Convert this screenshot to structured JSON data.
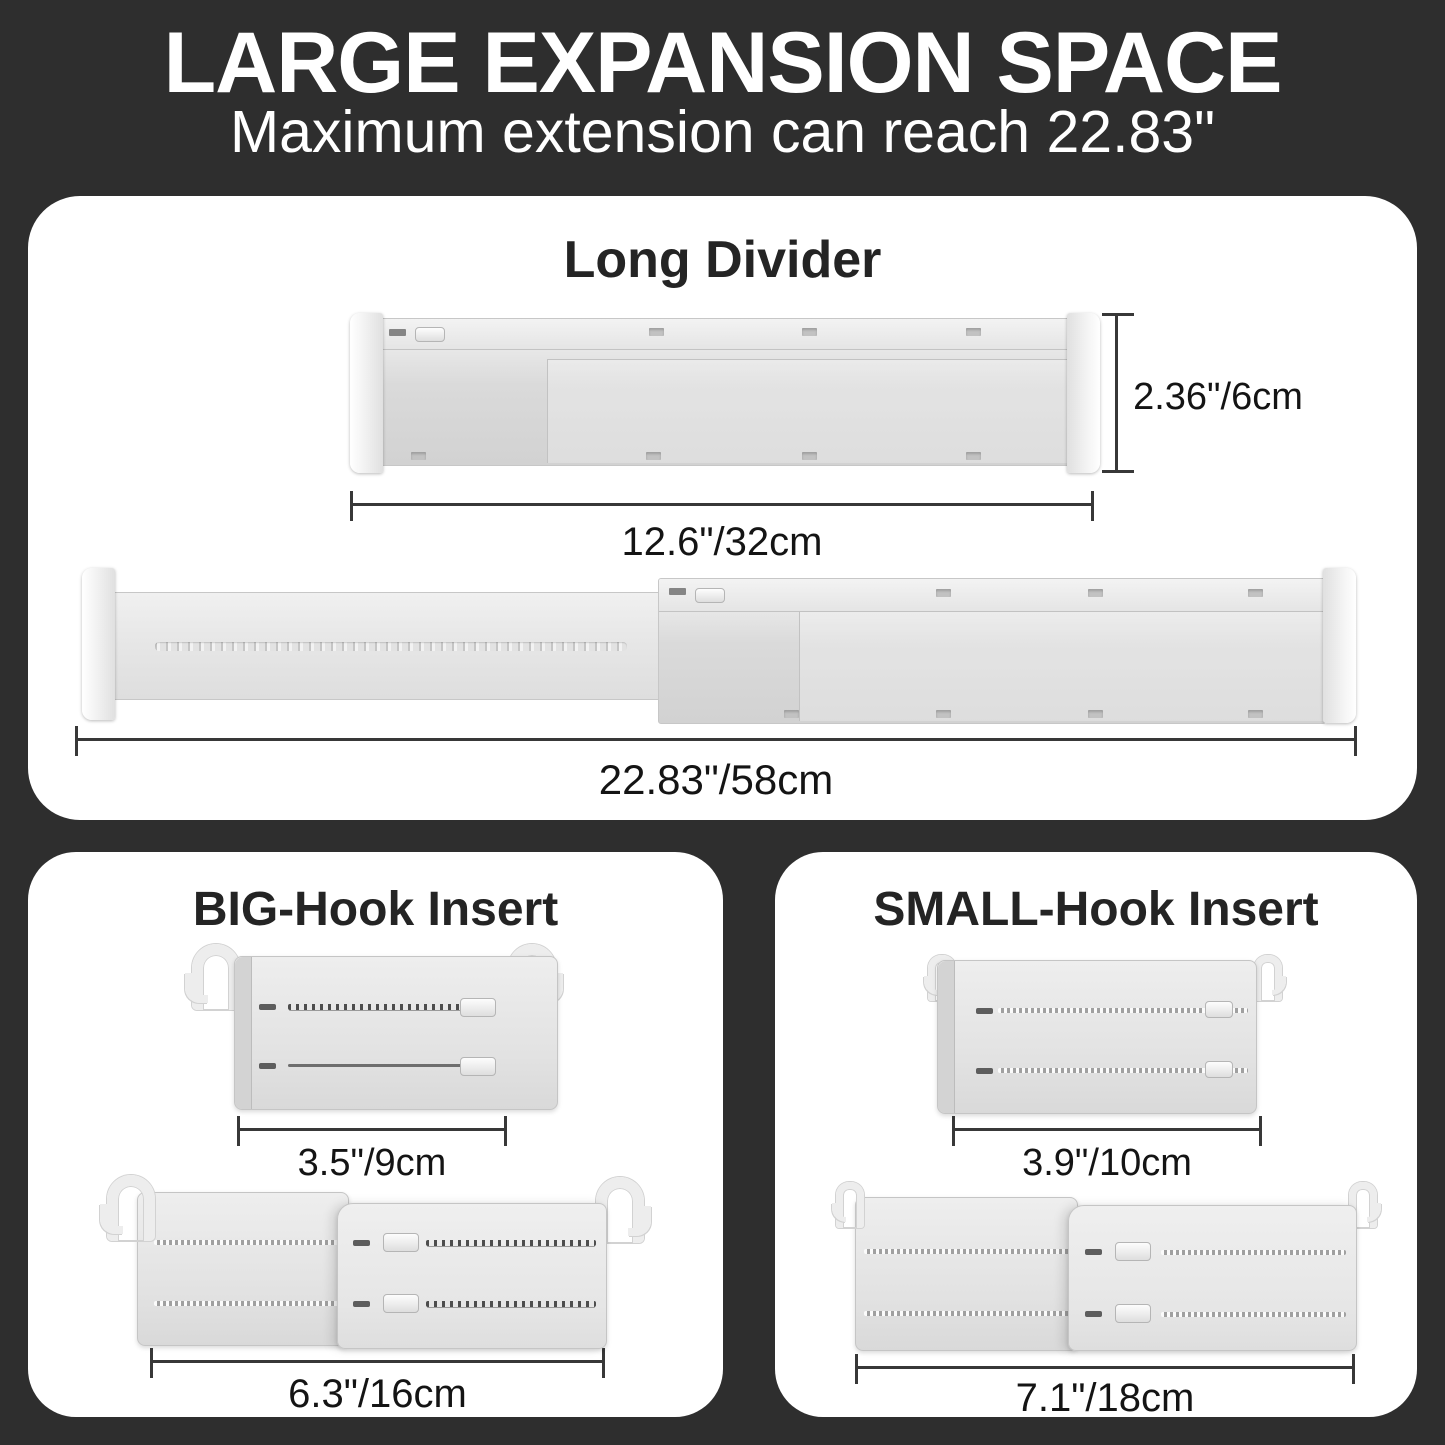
{
  "header": {
    "title": "LARGE EXPANSION SPACE",
    "subtitle": "Maximum extension can reach 22.83\""
  },
  "long_divider": {
    "title": "Long Divider",
    "collapsed_height_label": "2.36\"/6cm",
    "collapsed_width_label": "12.6\"/32cm",
    "extended_width_label": "22.83\"/58cm"
  },
  "big_hook": {
    "title": "BIG-Hook Insert",
    "compact_width_label": "3.5\"/9cm",
    "extended_width_label": "6.3\"/16cm"
  },
  "small_hook": {
    "title": "SMALL-Hook Insert",
    "compact_width_label": "3.9\"/10cm",
    "extended_width_label": "7.1\"/18cm"
  },
  "colors": {
    "background": "#2e2e2e",
    "panel": "#ffffff",
    "headline_text": "#ffffff",
    "title_text": "#242424",
    "dimension_line": "#383838",
    "product_light": "#ededed",
    "product_mid": "#d9d9d9"
  }
}
